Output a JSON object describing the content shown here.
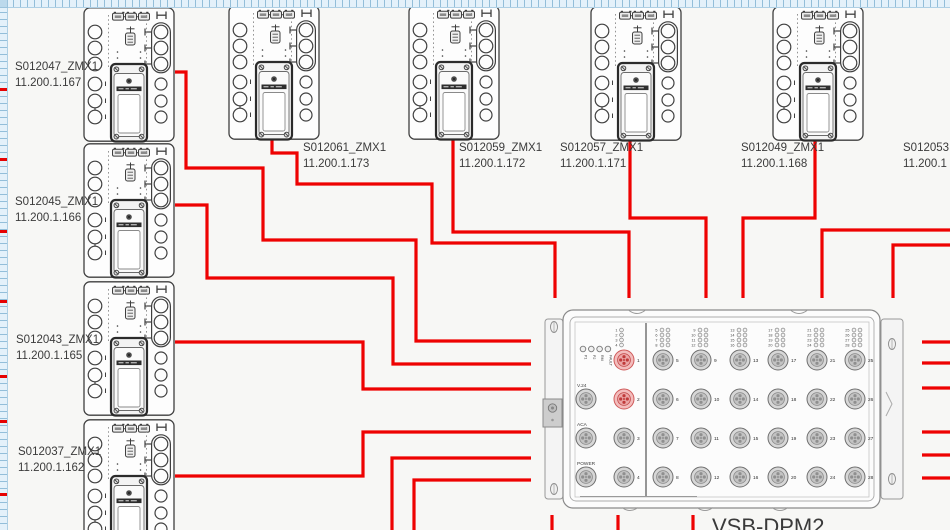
{
  "app": {
    "canvas_name": "wiring-diagram-canvas"
  },
  "colors": {
    "wire": "#ee0202",
    "line": "#3f3f3f",
    "ruler_marker": "#e60202",
    "highlight_port": "#cf5a5a"
  },
  "rulers": {
    "marker_ys": [
      88,
      158,
      230,
      300,
      375,
      420,
      493
    ]
  },
  "devices": [
    {
      "name": "S012047_ZMX1",
      "ip": "11.200.1.167"
    },
    {
      "name": "S012045_ZMX1",
      "ip": "11.200.1.166"
    },
    {
      "name": "S012043_ZMX1",
      "ip": "11.200.1.165"
    },
    {
      "name": "S012037_ZMX1",
      "ip": "11.200.1.162"
    },
    {
      "name": "S012061_ZMX1",
      "ip": "11.200.1.173"
    },
    {
      "name": "S012059_ZMX1",
      "ip": "11.200.1.172"
    },
    {
      "name": "S012057_ZMX1",
      "ip": "11.200.1.171"
    },
    {
      "name": "S012049_ZMX1",
      "ip": "11.200.1.168"
    },
    {
      "name": "S012053",
      "ip": "11.200.1"
    }
  ],
  "panel": {
    "title": "VSB-DPM2",
    "status_leds": [
      "P1",
      "P2",
      "RM",
      "FAULT"
    ],
    "aux_ports": [
      "V.24",
      "ACA",
      "POWER"
    ],
    "left_ports": [
      "1",
      "2",
      "3",
      "4"
    ],
    "highlighted_ports": [
      "1",
      "2"
    ],
    "port_columns": [
      [
        "5",
        "6",
        "7",
        "8"
      ],
      [
        "9",
        "10",
        "11",
        "12"
      ],
      [
        "13",
        "14",
        "15",
        "16"
      ],
      [
        "17",
        "18",
        "19",
        "20"
      ],
      [
        "21",
        "22",
        "23",
        "24"
      ],
      [
        "25",
        "26",
        "27",
        "28"
      ]
    ]
  }
}
